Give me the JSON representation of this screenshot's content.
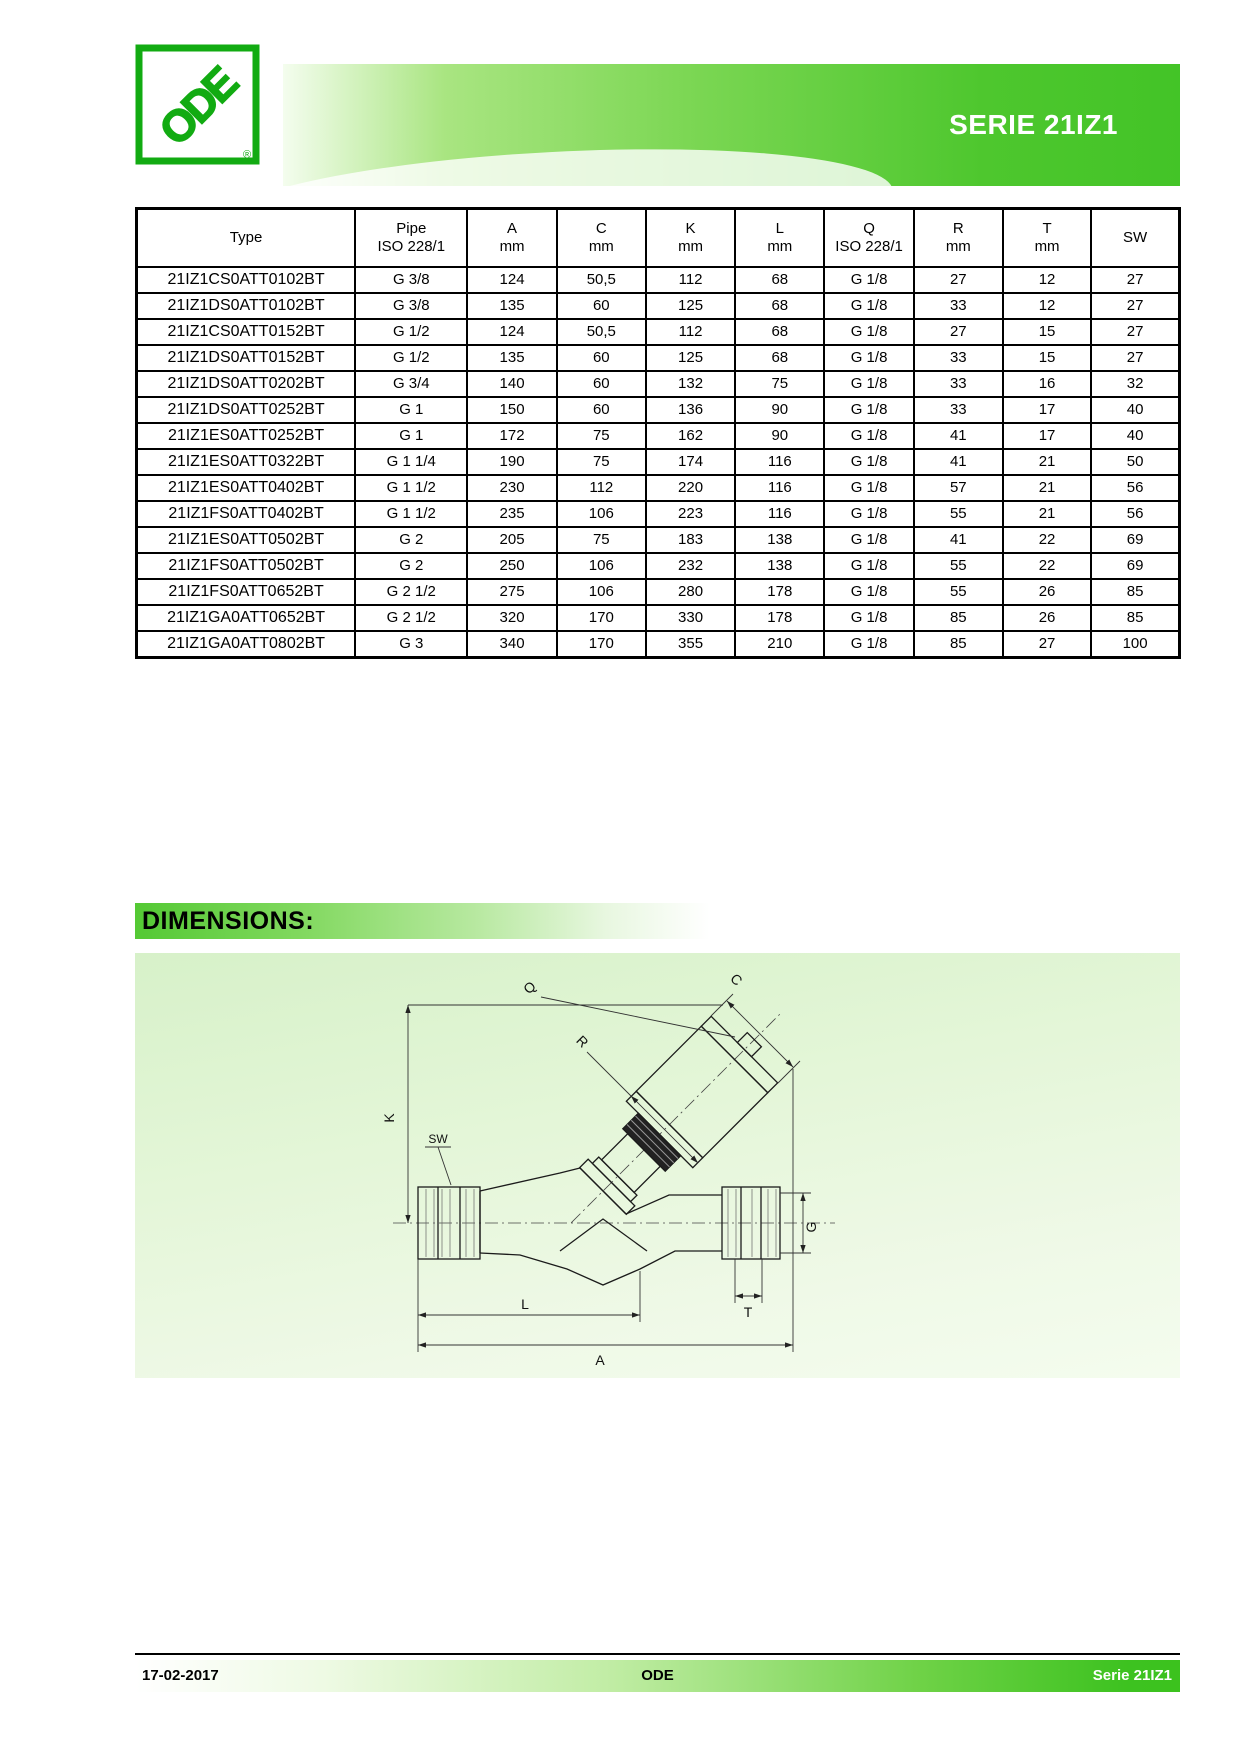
{
  "header": {
    "logo_text": "ODE",
    "logo_registered": "®",
    "series_title": "SERIE 21IZ1"
  },
  "table": {
    "headers": [
      {
        "line1": "Type",
        "line2": ""
      },
      {
        "line1": "Pipe",
        "line2": "ISO 228/1"
      },
      {
        "line1": "A",
        "line2": "mm"
      },
      {
        "line1": "C",
        "line2": "mm"
      },
      {
        "line1": "K",
        "line2": "mm"
      },
      {
        "line1": "L",
        "line2": "mm"
      },
      {
        "line1": "Q",
        "line2": "ISO 228/1"
      },
      {
        "line1": "R",
        "line2": "mm"
      },
      {
        "line1": "T",
        "line2": "mm"
      },
      {
        "line1": "SW",
        "line2": ""
      }
    ],
    "rows": [
      [
        "21IZ1CS0ATT0102BT",
        "G 3/8",
        "124",
        "50,5",
        "112",
        "68",
        "G 1/8",
        "27",
        "12",
        "27"
      ],
      [
        "21IZ1DS0ATT0102BT",
        "G 3/8",
        "135",
        "60",
        "125",
        "68",
        "G 1/8",
        "33",
        "12",
        "27"
      ],
      [
        "21IZ1CS0ATT0152BT",
        "G 1/2",
        "124",
        "50,5",
        "112",
        "68",
        "G 1/8",
        "27",
        "15",
        "27"
      ],
      [
        "21IZ1DS0ATT0152BT",
        "G 1/2",
        "135",
        "60",
        "125",
        "68",
        "G 1/8",
        "33",
        "15",
        "27"
      ],
      [
        "21IZ1DS0ATT0202BT",
        "G 3/4",
        "140",
        "60",
        "132",
        "75",
        "G 1/8",
        "33",
        "16",
        "32"
      ],
      [
        "21IZ1DS0ATT0252BT",
        "G 1",
        "150",
        "60",
        "136",
        "90",
        "G 1/8",
        "33",
        "17",
        "40"
      ],
      [
        "21IZ1ES0ATT0252BT",
        "G 1",
        "172",
        "75",
        "162",
        "90",
        "G 1/8",
        "41",
        "17",
        "40"
      ],
      [
        "21IZ1ES0ATT0322BT",
        "G 1 1/4",
        "190",
        "75",
        "174",
        "116",
        "G 1/8",
        "41",
        "21",
        "50"
      ],
      [
        "21IZ1ES0ATT0402BT",
        "G 1 1/2",
        "230",
        "112",
        "220",
        "116",
        "G 1/8",
        "57",
        "21",
        "56"
      ],
      [
        "21IZ1FS0ATT0402BT",
        "G 1 1/2",
        "235",
        "106",
        "223",
        "116",
        "G 1/8",
        "55",
        "21",
        "56"
      ],
      [
        "21IZ1ES0ATT0502BT",
        "G 2",
        "205",
        "75",
        "183",
        "138",
        "G 1/8",
        "41",
        "22",
        "69"
      ],
      [
        "21IZ1FS0ATT0502BT",
        "G 2",
        "250",
        "106",
        "232",
        "138",
        "G 1/8",
        "55",
        "22",
        "69"
      ],
      [
        "21IZ1FS0ATT0652BT",
        "G 2 1/2",
        "275",
        "106",
        "280",
        "178",
        "G 1/8",
        "55",
        "26",
        "85"
      ],
      [
        "21IZ1GA0ATT0652BT",
        "G 2 1/2",
        "320",
        "170",
        "330",
        "178",
        "G 1/8",
        "85",
        "26",
        "85"
      ],
      [
        "21IZ1GA0ATT0802BT",
        "G 3",
        "340",
        "170",
        "355",
        "210",
        "G 1/8",
        "85",
        "27",
        "100"
      ]
    ]
  },
  "dimensions": {
    "heading": "DIMENSIONS:"
  },
  "diagram": {
    "labels": {
      "a": "A",
      "c": "C",
      "g": "G",
      "k": "K",
      "l": "L",
      "q": "Q",
      "r": "R",
      "sw": "SW",
      "t": "T"
    }
  },
  "footer": {
    "date": "17-02-2017",
    "company": "ODE",
    "series": "Serie 21IZ1"
  },
  "colors": {
    "brand_green": "#3fc21f",
    "banner_green": "#45c528",
    "light_green": "#d7f1c9",
    "logo_green": "#12ab12"
  }
}
